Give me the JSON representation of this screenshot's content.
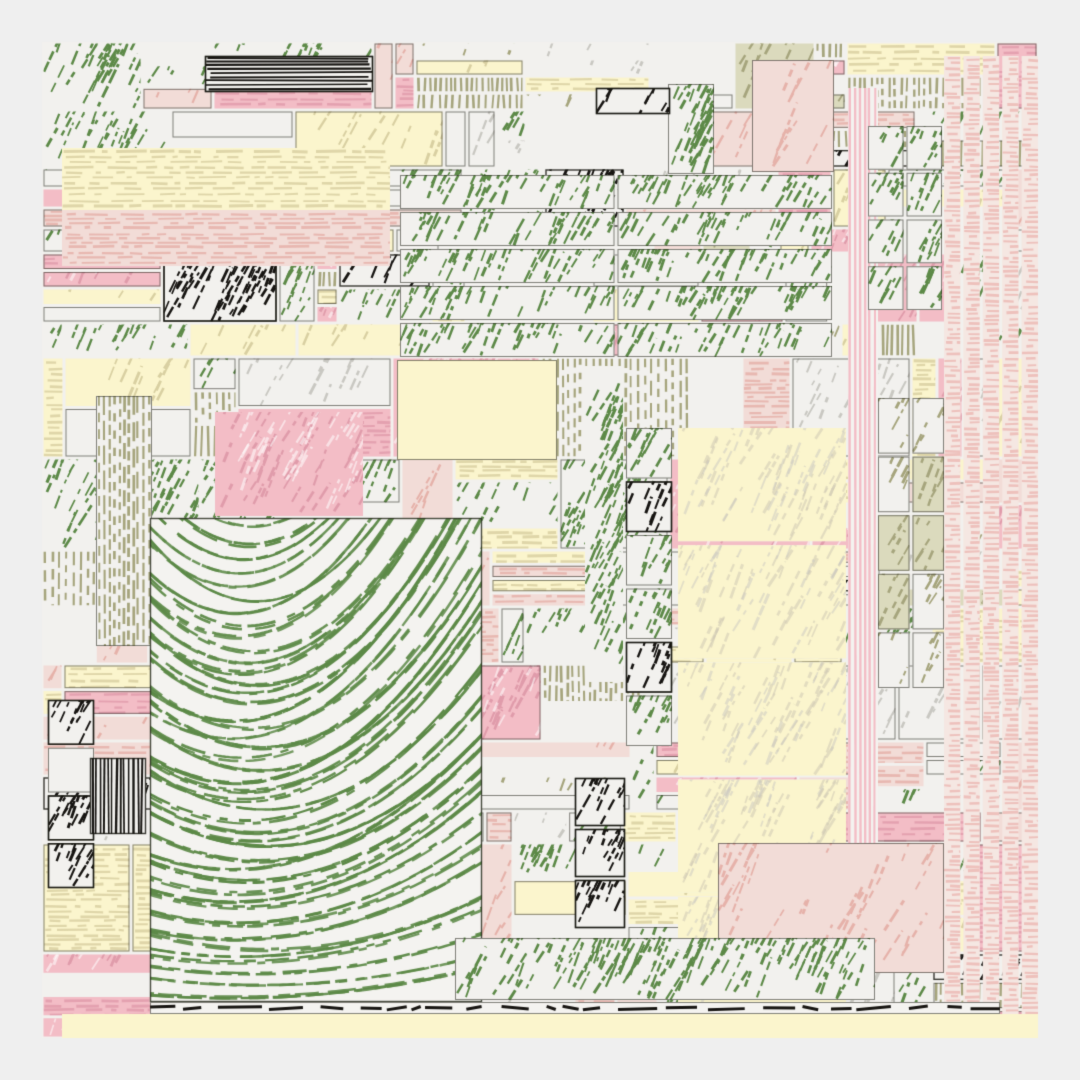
{
  "artwork": {
    "kind": "generative-hatched-mosaic",
    "width": 1080,
    "height": 1080,
    "margin": 42,
    "seed": 11,
    "outer_background": "#efefef",
    "paper_background": "#f2f1ee",
    "palette": {
      "paper": "#f2f1ee",
      "white": "#f4f3f0",
      "green": "#5d8a48",
      "green_deep": "#4c7a3a",
      "pink": "#f3bdc6",
      "pink_stroke": "#e09cab",
      "blush": "#f2dcd7",
      "blush_stroke": "#e6b2aa",
      "cream": "#fbf5cd",
      "cream_stroke": "#d9d0a2",
      "olive": "#c3c2a0",
      "olive_deep": "#a6a57d",
      "black": "#171512",
      "gray_stroke": "#c9c8c2",
      "outline": "rgba(35,35,25,0.55)"
    },
    "color_weights": {
      "white": 0.26,
      "cream": 0.15,
      "pink": 0.13,
      "blush": 0.14,
      "green": 0.19,
      "olive": 0.09,
      "black": 0.04
    },
    "mosaic": {
      "row_height_min": 24,
      "row_height_max": 110,
      "cell_width_min": 20,
      "cell_width_max": 170,
      "gap": 1.5,
      "substrip_prob": 0.5,
      "subcol_prob": 0.22,
      "outline_prob": 0.38
    },
    "features": [
      {
        "id": "cream-band-topleft",
        "kind": "cell",
        "x": 62,
        "y": 148,
        "w": 328,
        "h": 62,
        "color": "cream",
        "texture": "hdash"
      },
      {
        "id": "blush-band-topleft",
        "kind": "cell",
        "x": 62,
        "y": 210,
        "w": 328,
        "h": 56,
        "color": "blush",
        "texture": "hdash"
      },
      {
        "id": "black-lines-block",
        "kind": "cell",
        "x": 205,
        "y": 56,
        "w": 168,
        "h": 36,
        "color": "black",
        "texture": "hlines"
      },
      {
        "id": "green-grid",
        "kind": "grid",
        "x": 400,
        "y": 175,
        "w": 432,
        "h": 182,
        "cols": 2,
        "rows": 5,
        "color": "green",
        "texture": "scribble-dense"
      },
      {
        "id": "cream-center",
        "kind": "cell",
        "x": 397,
        "y": 360,
        "w": 160,
        "h": 100,
        "color": "cream",
        "texture": "plain"
      },
      {
        "id": "pink-left-block",
        "kind": "cell",
        "x": 215,
        "y": 412,
        "w": 148,
        "h": 104,
        "color": "pink",
        "texture": "scribble"
      },
      {
        "id": "olive-stripe-col",
        "kind": "cell",
        "x": 96,
        "y": 396,
        "w": 56,
        "h": 250,
        "color": "olive",
        "texture": "vstripes"
      },
      {
        "id": "arc-square",
        "kind": "arcs",
        "x": 150,
        "y": 518,
        "w": 332,
        "h": 484,
        "arc_count": 44,
        "vertex_frac": 0.3,
        "sag_frac": 0.58,
        "edge_rise_frac": 0.05
      },
      {
        "id": "green-col-center",
        "kind": "cell",
        "x": 585,
        "y": 366,
        "w": 38,
        "h": 316,
        "color": "green",
        "texture": "scribble-dense"
      },
      {
        "id": "green-cells-col",
        "kind": "vcells",
        "x": 626,
        "y": 428,
        "w": 46,
        "h": 318,
        "colors": [
          "green",
          "black",
          "green",
          "green",
          "black",
          "green"
        ]
      },
      {
        "id": "cream-tall",
        "kind": "rows",
        "x": 678,
        "y": 428,
        "w": 168,
        "h": 582,
        "rows": 5,
        "color": "cream",
        "texture": "sparse-pale"
      },
      {
        "id": "pink-stripe-col",
        "kind": "cell",
        "x": 848,
        "y": 88,
        "w": 30,
        "h": 760,
        "color": "blush",
        "texture": "vstripes-pink"
      },
      {
        "id": "olive-grid-right",
        "kind": "grid",
        "x": 878,
        "y": 398,
        "w": 66,
        "h": 290,
        "cols": 2,
        "rows": 5,
        "color": "olive",
        "texture": "scribble"
      },
      {
        "id": "right-strip-column",
        "kind": "cols",
        "x": 944,
        "y": 56,
        "w": 94,
        "h": 982,
        "cols": 5,
        "color": "blush",
        "texture": "hdash"
      },
      {
        "id": "green-grid-topright",
        "kind": "grid",
        "x": 868,
        "y": 126,
        "w": 74,
        "h": 184,
        "cols": 2,
        "rows": 4,
        "color": "green",
        "texture": "scribble-dense"
      },
      {
        "id": "blush-top-block",
        "kind": "cell",
        "x": 752,
        "y": 60,
        "w": 82,
        "h": 112,
        "color": "blush",
        "texture": "scribble-light"
      },
      {
        "id": "green-solid-top",
        "kind": "cell",
        "x": 668,
        "y": 84,
        "w": 46,
        "h": 90,
        "color": "green",
        "texture": "scribble-solid"
      },
      {
        "id": "black-top-mid",
        "kind": "cell",
        "x": 596,
        "y": 88,
        "w": 74,
        "h": 26,
        "color": "black",
        "texture": "scribble-dense"
      },
      {
        "id": "black-col-bottom",
        "kind": "vcells",
        "x": 575,
        "y": 778,
        "w": 50,
        "h": 150,
        "colors": [
          "black",
          "black",
          "black"
        ]
      },
      {
        "id": "blush-bottom-right",
        "kind": "cell",
        "x": 718,
        "y": 843,
        "w": 226,
        "h": 130,
        "color": "blush",
        "texture": "scribble-light"
      },
      {
        "id": "green-bottom-bar",
        "kind": "cell",
        "x": 455,
        "y": 938,
        "w": 420,
        "h": 62,
        "color": "green",
        "texture": "scribble-dense"
      },
      {
        "id": "black-left-cluster",
        "kind": "vcells",
        "x": 48,
        "y": 700,
        "w": 46,
        "h": 188,
        "colors": [
          "black",
          "white",
          "black",
          "black"
        ]
      },
      {
        "id": "black-vlines-block",
        "kind": "cell",
        "x": 90,
        "y": 758,
        "w": 56,
        "h": 76,
        "color": "black",
        "texture": "vlines"
      },
      {
        "id": "bottom-dash-strip",
        "kind": "cell",
        "x": 150,
        "y": 1002,
        "w": 850,
        "h": 12,
        "color": "white",
        "texture": "blackdash"
      },
      {
        "id": "cream-bottom-strip",
        "kind": "cell",
        "x": 62,
        "y": 1014,
        "w": 976,
        "h": 24,
        "color": "cream",
        "texture": "plain"
      }
    ]
  }
}
